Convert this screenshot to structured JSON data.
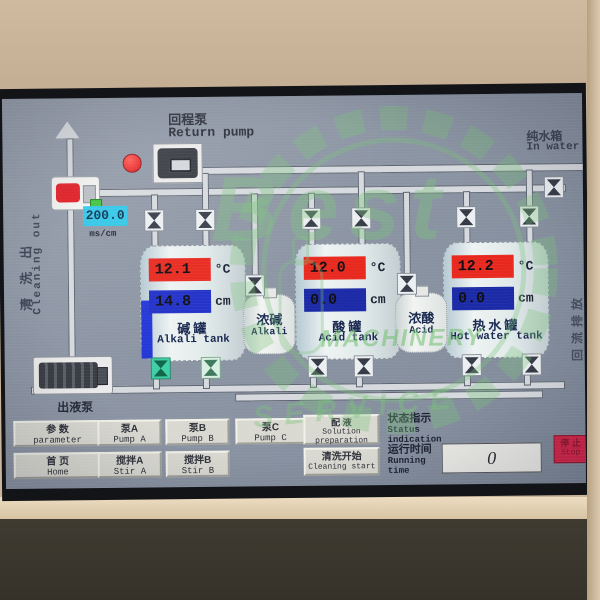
{
  "screen": {
    "return_pump": {
      "cn": "回程泵",
      "en": "Return pump"
    },
    "cleaning_out": {
      "cn": "清洗出",
      "en": "Cleaning out"
    },
    "in_water": {
      "cn": "纯水箱",
      "en": "In water"
    },
    "reflux_drain": {
      "cn": "回流排放"
    },
    "outlet_pump": {
      "cn": "出液泵"
    },
    "conductivity": {
      "value": "200.0",
      "unit": "ms/cm"
    },
    "tanks": [
      {
        "temp": "12.1",
        "temp_unit": "°C",
        "level": "14.8",
        "level_unit": "cm",
        "name_cn": "碱罐",
        "name_en": "Alkali tank"
      },
      {
        "temp": "12.0",
        "temp_unit": "°C",
        "level": "0.0",
        "level_unit": "cm",
        "name_cn": "酸罐",
        "name_en": "Acid tank"
      },
      {
        "temp": "12.2",
        "temp_unit": "°C",
        "level": "0.0",
        "level_unit": "cm",
        "name_cn": "热水罐",
        "name_en": "Hot water tank"
      }
    ],
    "small_tanks": [
      {
        "name_cn": "浓碱",
        "name_en": "Alkali"
      },
      {
        "name_cn": "浓酸",
        "name_en": "Acid"
      }
    ],
    "buttons": {
      "parameter": {
        "cn": "参  数",
        "en": "parameter"
      },
      "home": {
        "cn": "首  页",
        "en": "Home"
      },
      "pump_a": {
        "cn": "泵A",
        "en": "Pump A"
      },
      "pump_b": {
        "cn": "泵B",
        "en": "Pump B"
      },
      "pump_c": {
        "cn": "泵C",
        "en": "Pump C"
      },
      "stir_a": {
        "cn": "搅拌A",
        "en": "Stir A"
      },
      "stir_b": {
        "cn": "搅拌B",
        "en": "Stir B"
      },
      "solution": {
        "cn": "配  液",
        "en1": "Solution",
        "en2": "preparation"
      },
      "cleaning_start": {
        "cn": "清洗开始",
        "en": "Cleaning start"
      },
      "stop": {
        "cn": "停 止",
        "en": "Stop"
      }
    },
    "status": {
      "cn": "状态指示",
      "en1": "Status",
      "en2": "indication"
    },
    "running_time": {
      "cn": "运行时间",
      "en1": "Running",
      "en2": "time",
      "value": "0"
    }
  },
  "colors": {
    "alarm_red": "#e21820",
    "level_blue": "#2337d8",
    "conductivity_cyan": "#2fc6e8",
    "valve_open_green": "#3ecfa6",
    "stop_red": "#d42448",
    "watermark_green": "#79c479"
  },
  "watermark": {
    "word1": "Best",
    "word2": "MACHINERY",
    "word3": "SERVICE"
  }
}
